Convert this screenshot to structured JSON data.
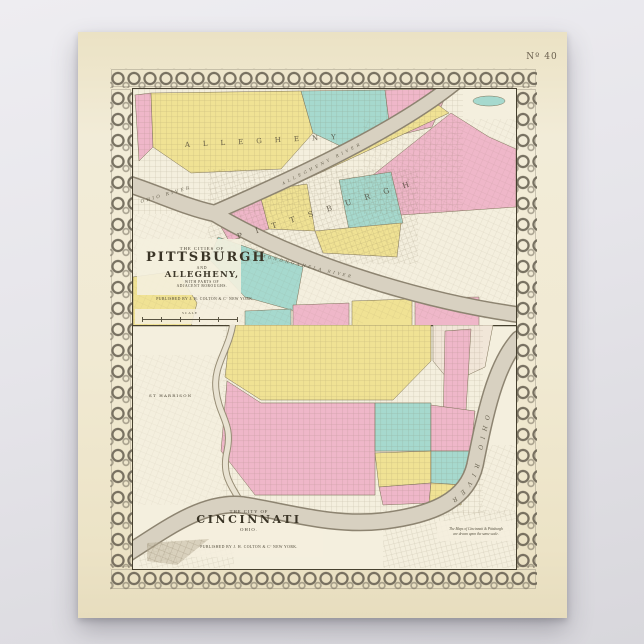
{
  "palette": {
    "backdrop": "#e9e8ec",
    "poster": "#efe7cd",
    "paper": "#f4efde",
    "ward_yellow": "#f0e294",
    "ward_pink": "#efb7c9",
    "ward_teal": "#a6d9ce",
    "river": "#d8d1c1",
    "ink": "#3f392e"
  },
  "plate": {
    "number": "Nº 40"
  },
  "pittsburgh": {
    "title_small": "THE CITIES OF",
    "title_main": "PITTSBURGH",
    "title_and": "AND",
    "title_sub": "ALLEGHENY,",
    "title_note1": "WITH PARTS OF",
    "title_note2": "ADJACENT BOROUGHS.",
    "publisher": "PUBLISHED BY J. H. COLTON & Cº NEW YORK.",
    "scale_label": "SCALE",
    "labels": {
      "city_north": "ALLEGHENY",
      "city_main": "PITTSBURGH",
      "river_west": "OHIO RIVER",
      "river_north": "ALLEGHENY RIVER",
      "river_south": "MONONGAHELA RIVER"
    }
  },
  "cincinnati": {
    "title_small": "THE CITY OF",
    "title_main": "CINCINNATI",
    "title_sub": "OHIO.",
    "publisher": "PUBLISHED BY J. H. COLTON & Cº NEW YORK.",
    "note_line1": "The Maps of Cincinnati & Pittsburgh",
    "note_line2": "are drawn upon the same scale.",
    "labels": {
      "west_district": "ST HARRISON",
      "river": "OHIO RIVER"
    }
  }
}
